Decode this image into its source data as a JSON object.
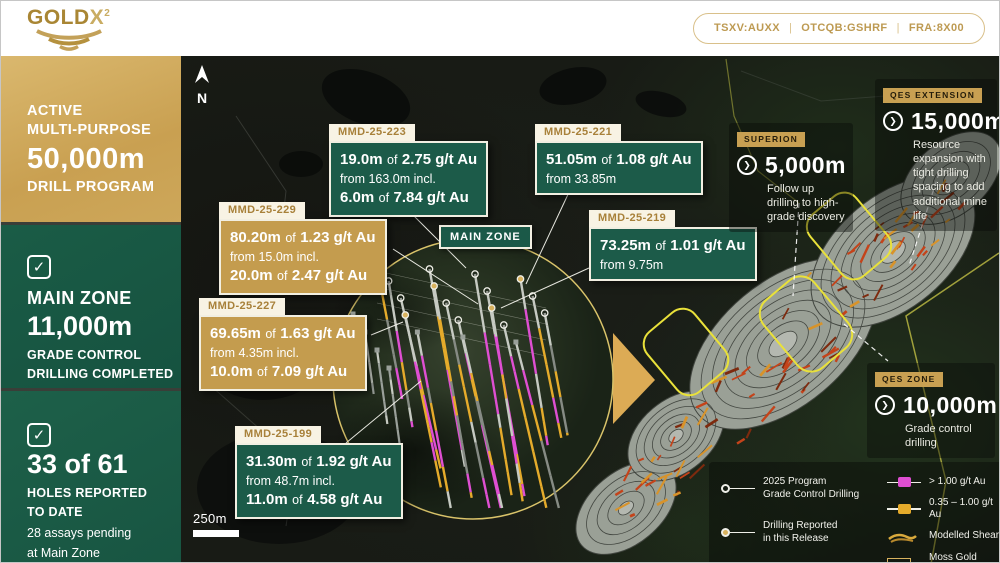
{
  "header": {
    "logo": {
      "word": "GOLD",
      "x": "X",
      "sup": "2"
    },
    "tickers": [
      "TSXV:AUXX",
      "OTCQB:GSHRF",
      "FRA:8X00"
    ],
    "separator": "|"
  },
  "sidebar": {
    "program": {
      "l1": "ACTIVE",
      "l2": "MULTI-PURPOSE",
      "big": "50,000m",
      "l3": "DRILL PROGRAM"
    },
    "main_zone": {
      "title": "MAIN ZONE",
      "big": "11,000m",
      "l1": "GRADE CONTROL",
      "l2": "DRILLING COMPLETED"
    },
    "holes": {
      "big": "33 of 61",
      "l1": "HOLES REPORTED",
      "l2": "TO DATE",
      "s1": "28 assays pending",
      "s2": "at Main Zone"
    }
  },
  "map": {
    "north": "N",
    "scale": "250m",
    "zone_tag": "MAIN ZONE",
    "callouts": [
      {
        "id": "MMD-25-223",
        "v1": "19.0m",
        "of1": "of",
        "g1": "2.75 g/t Au",
        "from": "from 163.0m incl.",
        "v2": "6.0m",
        "of2": "of",
        "g2": "7.84 g/t Au"
      },
      {
        "id": "MMD-25-221",
        "v1": "51.05m",
        "of1": "of",
        "g1": "1.08 g/t Au",
        "from": "from 33.85m"
      },
      {
        "id": "MMD-25-229",
        "v1": "80.20m",
        "of1": "of",
        "g1": "1.23 g/t Au",
        "from": "from 15.0m incl.",
        "v2": "20.0m",
        "of2": "of",
        "g2": "2.47 g/t Au"
      },
      {
        "id": "MMD-25-219",
        "v1": "73.25m",
        "of1": "of",
        "g1": "1.01 g/t Au",
        "from": "from 9.75m"
      },
      {
        "id": "MMD-25-227",
        "v1": "69.65m",
        "of1": "of",
        "g1": "1.63 g/t Au",
        "from": "from 4.35m incl.",
        "v2": "10.0m",
        "of2": "of",
        "g2": "7.09 g/t Au"
      },
      {
        "id": "MMD-25-199",
        "v1": "31.30m",
        "of1": "of",
        "g1": "1.92 g/t Au",
        "from": "from 48.7m incl.",
        "v2": "11.0m",
        "of2": "of",
        "g2": "4.58 g/t Au"
      }
    ],
    "targets": [
      {
        "tag": "QES EXTENSION",
        "value": "15,000m",
        "desc": "Resource expansion with tight drilling spacing to add additional mine life"
      },
      {
        "tag": "SUPERION",
        "value": "5,000m",
        "desc": "Follow up drilling to high-grade discovery"
      },
      {
        "tag": "QES ZONE",
        "value": "10,000m",
        "desc": "Grade control drilling"
      }
    ],
    "legend": {
      "left": [
        {
          "l1": "2025 Program",
          "l2": "Grade Control Drilling"
        },
        {
          "l1": "Drilling Reported",
          "l2": "in this Release"
        },
        {
          "l1": "Assays Pending",
          "l2": ""
        }
      ],
      "right": [
        {
          "label": "> 1.00 g/t Au"
        },
        {
          "label": "0.35 – 1.00 g/t Au"
        },
        {
          "label": "Modelled Shears"
        },
        {
          "label": "Moss Gold Project"
        }
      ]
    }
  },
  "icons": {
    "check": "✓",
    "chevron": "❯"
  },
  "colors": {
    "gold": "#c8a157",
    "green": "#1a5a45",
    "magenta": "#df4fd2",
    "interval_gold": "#e5ab2b",
    "trace_gray": "#c6cac2",
    "yellow": "#e9e13a",
    "orange": "#c4431a",
    "amber": "#d8932a",
    "cream": "#f8f3e4",
    "contour_gray": "#9aa096"
  }
}
